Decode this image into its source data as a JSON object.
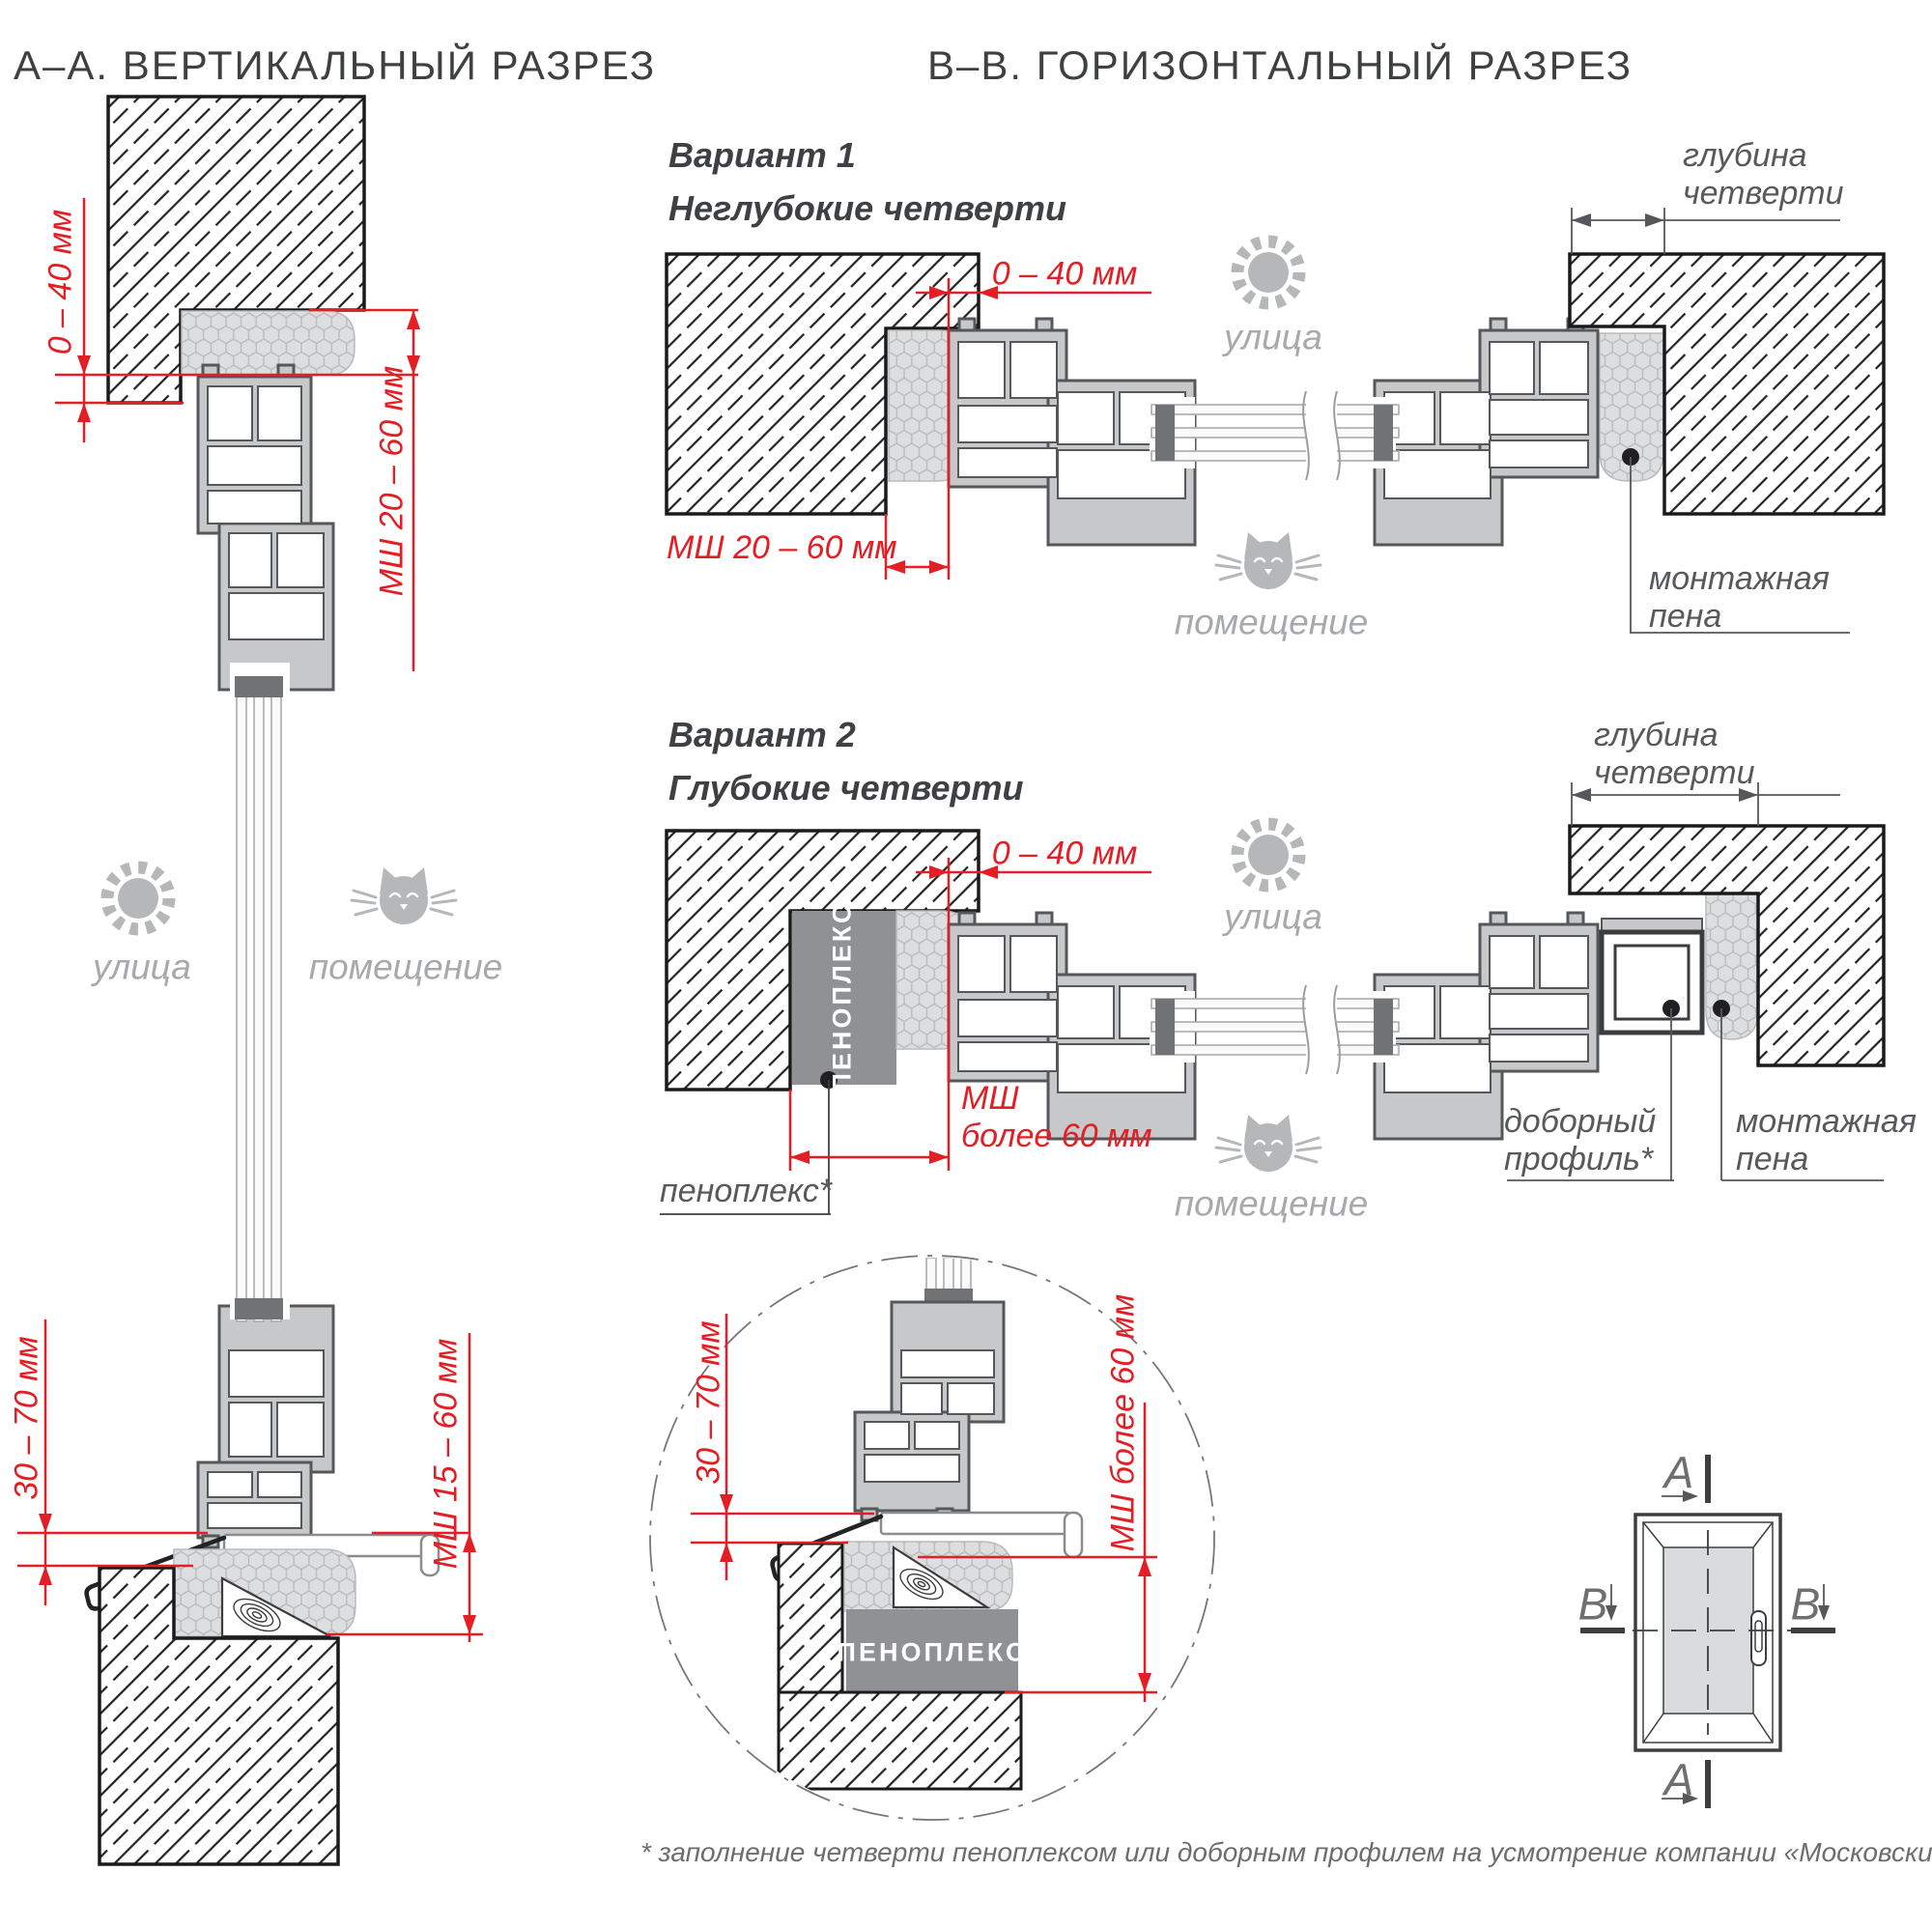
{
  "header": {
    "section_a": "А–А. ВЕРТИКАЛЬНЫЙ РАЗРЕЗ",
    "section_b": "B–B. ГОРИЗОНТАЛЬНЫЙ РАЗРЕЗ"
  },
  "common": {
    "street": "улица",
    "room": "помещение",
    "quarter_depth": "глубина\nчетверти",
    "mounting_foam": "монтажная\nпена",
    "penoplex_caps": "ПЕНОПЛЕКС",
    "penoplex_note": "пеноплекс*",
    "extension_profile": "доборный\nпрофиль*"
  },
  "vertical_section": {
    "dim_top_offset": "0 – 40 мм",
    "dim_top_seam": "МШ  20 – 60 мм",
    "dim_bottom_offset": "30 – 70 мм",
    "dim_bottom_seam": "МШ  15 – 60 мм"
  },
  "variant1": {
    "title": "Вариант 1",
    "subtitle": "Неглубокие четверти",
    "dim_offset": "0 – 40 мм",
    "dim_seam": "МШ  20 – 60 мм"
  },
  "variant2": {
    "title": "Вариант 2",
    "subtitle": "Глубокие четверти",
    "dim_offset": "0 – 40 мм",
    "dim_seam": "МШ\nболее 60  мм"
  },
  "detail": {
    "dim_offset": "30 – 70 мм",
    "dim_seam": "МШ более 60  мм",
    "penoplex_caps": "ПЕНОПЛЕКС"
  },
  "key_plan": {
    "a": "A",
    "b": "B"
  },
  "footnote": "* заполнение четверти пеноплексом или доборным профилем на усмотрение компании «Московские окна».",
  "colors": {
    "dimension_red": "#e31e24",
    "label_gray": "#58595b",
    "light_gray": "#a7a9ac",
    "profile_fill": "#c6c8ca",
    "foam_fill": "#dcdedf",
    "penoplex_fill": "#8f9194"
  }
}
